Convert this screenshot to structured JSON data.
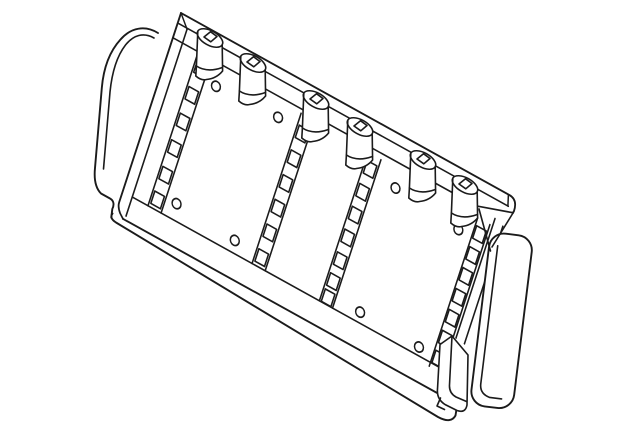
{
  "meta": {
    "canvas": {
      "width": 640,
      "height": 429
    },
    "background_color": "#ffffff",
    "stroke_color": "#1b1b1b"
  },
  "diagram": {
    "subject": "rear-seat-back-frame-panel-line-illustration",
    "panel_sections": 3,
    "clip_count": 6,
    "slot_strip_count": 4,
    "hole_count": 8,
    "clips": [
      [
        210,
        38
      ],
      [
        253,
        63
      ],
      [
        316,
        100
      ],
      [
        360,
        127
      ],
      [
        423,
        160
      ],
      [
        465,
        185
      ]
    ],
    "slot_strips": [
      {
        "x1": 29,
        "x2": 44,
        "top": 28,
        "bottom": 188,
        "slots": [
          40,
          68,
          96,
          124,
          152,
          178
        ]
      },
      {
        "x1": 148,
        "x2": 163,
        "top": 30,
        "bottom": 188,
        "slots": [
          48,
          74,
          100,
          126,
          152,
          178
        ]
      },
      {
        "x1": 225,
        "x2": 240,
        "top": 32,
        "bottom": 188,
        "slots": [
          46,
          70,
          94,
          118,
          142,
          164,
          181
        ]
      },
      {
        "x1": 352,
        "x2": 366,
        "top": 36,
        "bottom": 192,
        "slots": [
          50,
          72,
          94,
          116,
          138,
          160,
          181
        ]
      }
    ],
    "holes": [
      [
        57,
        48
      ],
      [
        127,
        45
      ],
      [
        263,
        50
      ],
      [
        337,
        56
      ],
      [
        56,
        172
      ],
      [
        124,
        176
      ],
      [
        268,
        178
      ],
      [
        336,
        180
      ]
    ]
  }
}
